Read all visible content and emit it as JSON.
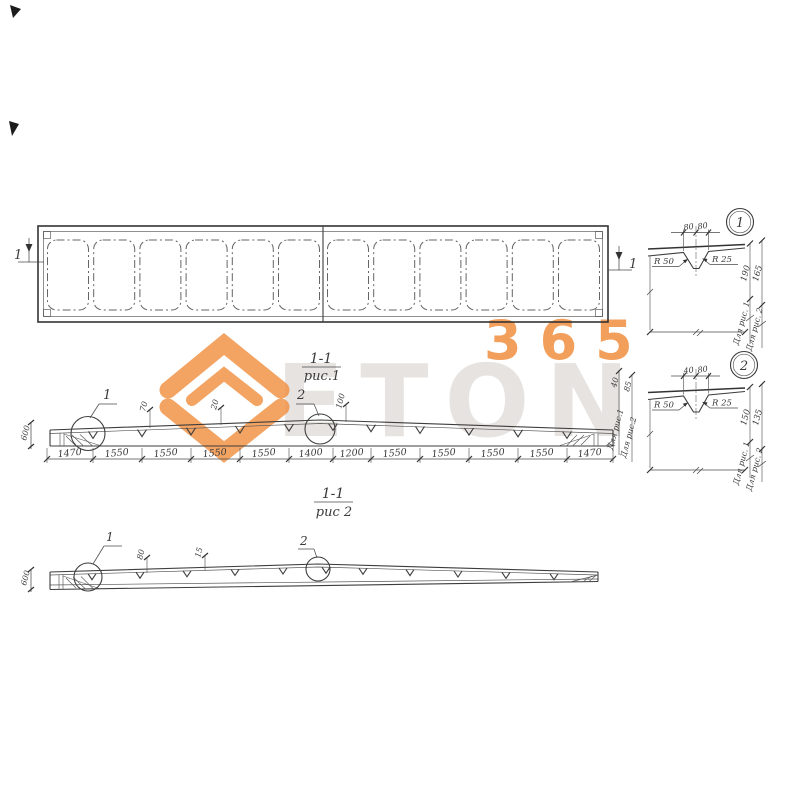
{
  "watermark": {
    "text": "ETON",
    "number": "365",
    "orange": "#f08f3f",
    "ghost_gray": "#c7c2bb"
  },
  "plan": {
    "section_mark_left": "1",
    "section_mark_right": "1"
  },
  "fig1": {
    "caption_top": "1-1",
    "caption_bottom": "рис.1",
    "detail1_mark": "1",
    "detail2_mark": "2",
    "dims": [
      "1470",
      "1550",
      "1550",
      "1550",
      "1550",
      "1400",
      "1200",
      "1550",
      "1550",
      "1550",
      "1550",
      "1470"
    ],
    "small_dim_a": "70",
    "small_dim_b": "20",
    "small_dim_c": "100",
    "left_height": "600",
    "right_dim_1": "40",
    "right_dim_2": "85",
    "for_fig1": "Для рис.1",
    "for_fig2": "Для рис.2"
  },
  "fig2": {
    "caption_top": "1-1",
    "caption_bottom": "рис 2",
    "detail1_mark": "1",
    "detail2_mark": "2",
    "small_dim_a": "80",
    "small_dim_b": "15",
    "left_height": "600"
  },
  "detail1": {
    "badge": "1",
    "dim_a": "80",
    "dim_b": "80",
    "radius_left": "R 50",
    "radius_right": "R 25",
    "height_1": "190",
    "height_2": "165",
    "for_fig1": "Для рис. 1",
    "for_fig2": "Для рис. 2"
  },
  "detail2": {
    "badge": "2",
    "dim_a": "40",
    "dim_b": "80",
    "radius_left": "R 50",
    "radius_right": "R 25",
    "height_1": "150",
    "height_2": "135",
    "for_fig1": "Для рис. 1",
    "for_fig2": "Для рис. 2"
  }
}
